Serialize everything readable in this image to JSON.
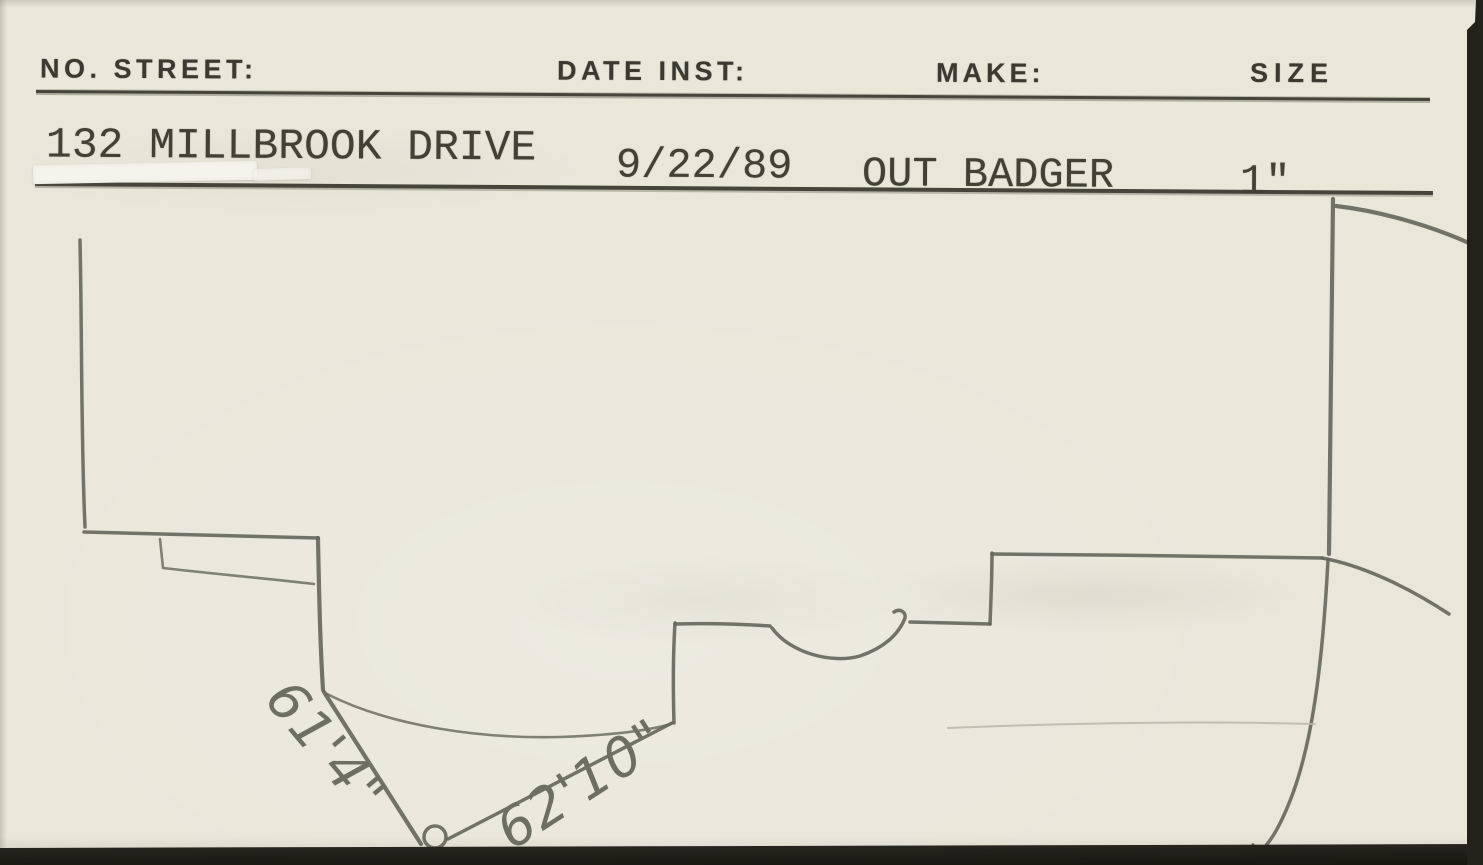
{
  "header": {
    "columns": [
      {
        "label": "NO. STREET:"
      },
      {
        "label": "DATE INST:"
      },
      {
        "label": "MAKE:"
      },
      {
        "label": "SIZE"
      }
    ]
  },
  "record": {
    "street": "132 MILLBROOK DRIVE",
    "date_installed": "9/22/89",
    "make": "OUT BADGER",
    "size": "1\""
  },
  "sketch": {
    "measurements": [
      {
        "label": "61'4\""
      },
      {
        "label": "62'10\""
      }
    ]
  },
  "colors": {
    "paper": "#e9e7da",
    "typed_ink": "#414136",
    "printed_ink": "#3a3a31",
    "rule_line": "#45453b",
    "pencil": "#65665b",
    "whiteout_tape": "#f5f4ec",
    "scan_edge": "#1c1c15"
  }
}
